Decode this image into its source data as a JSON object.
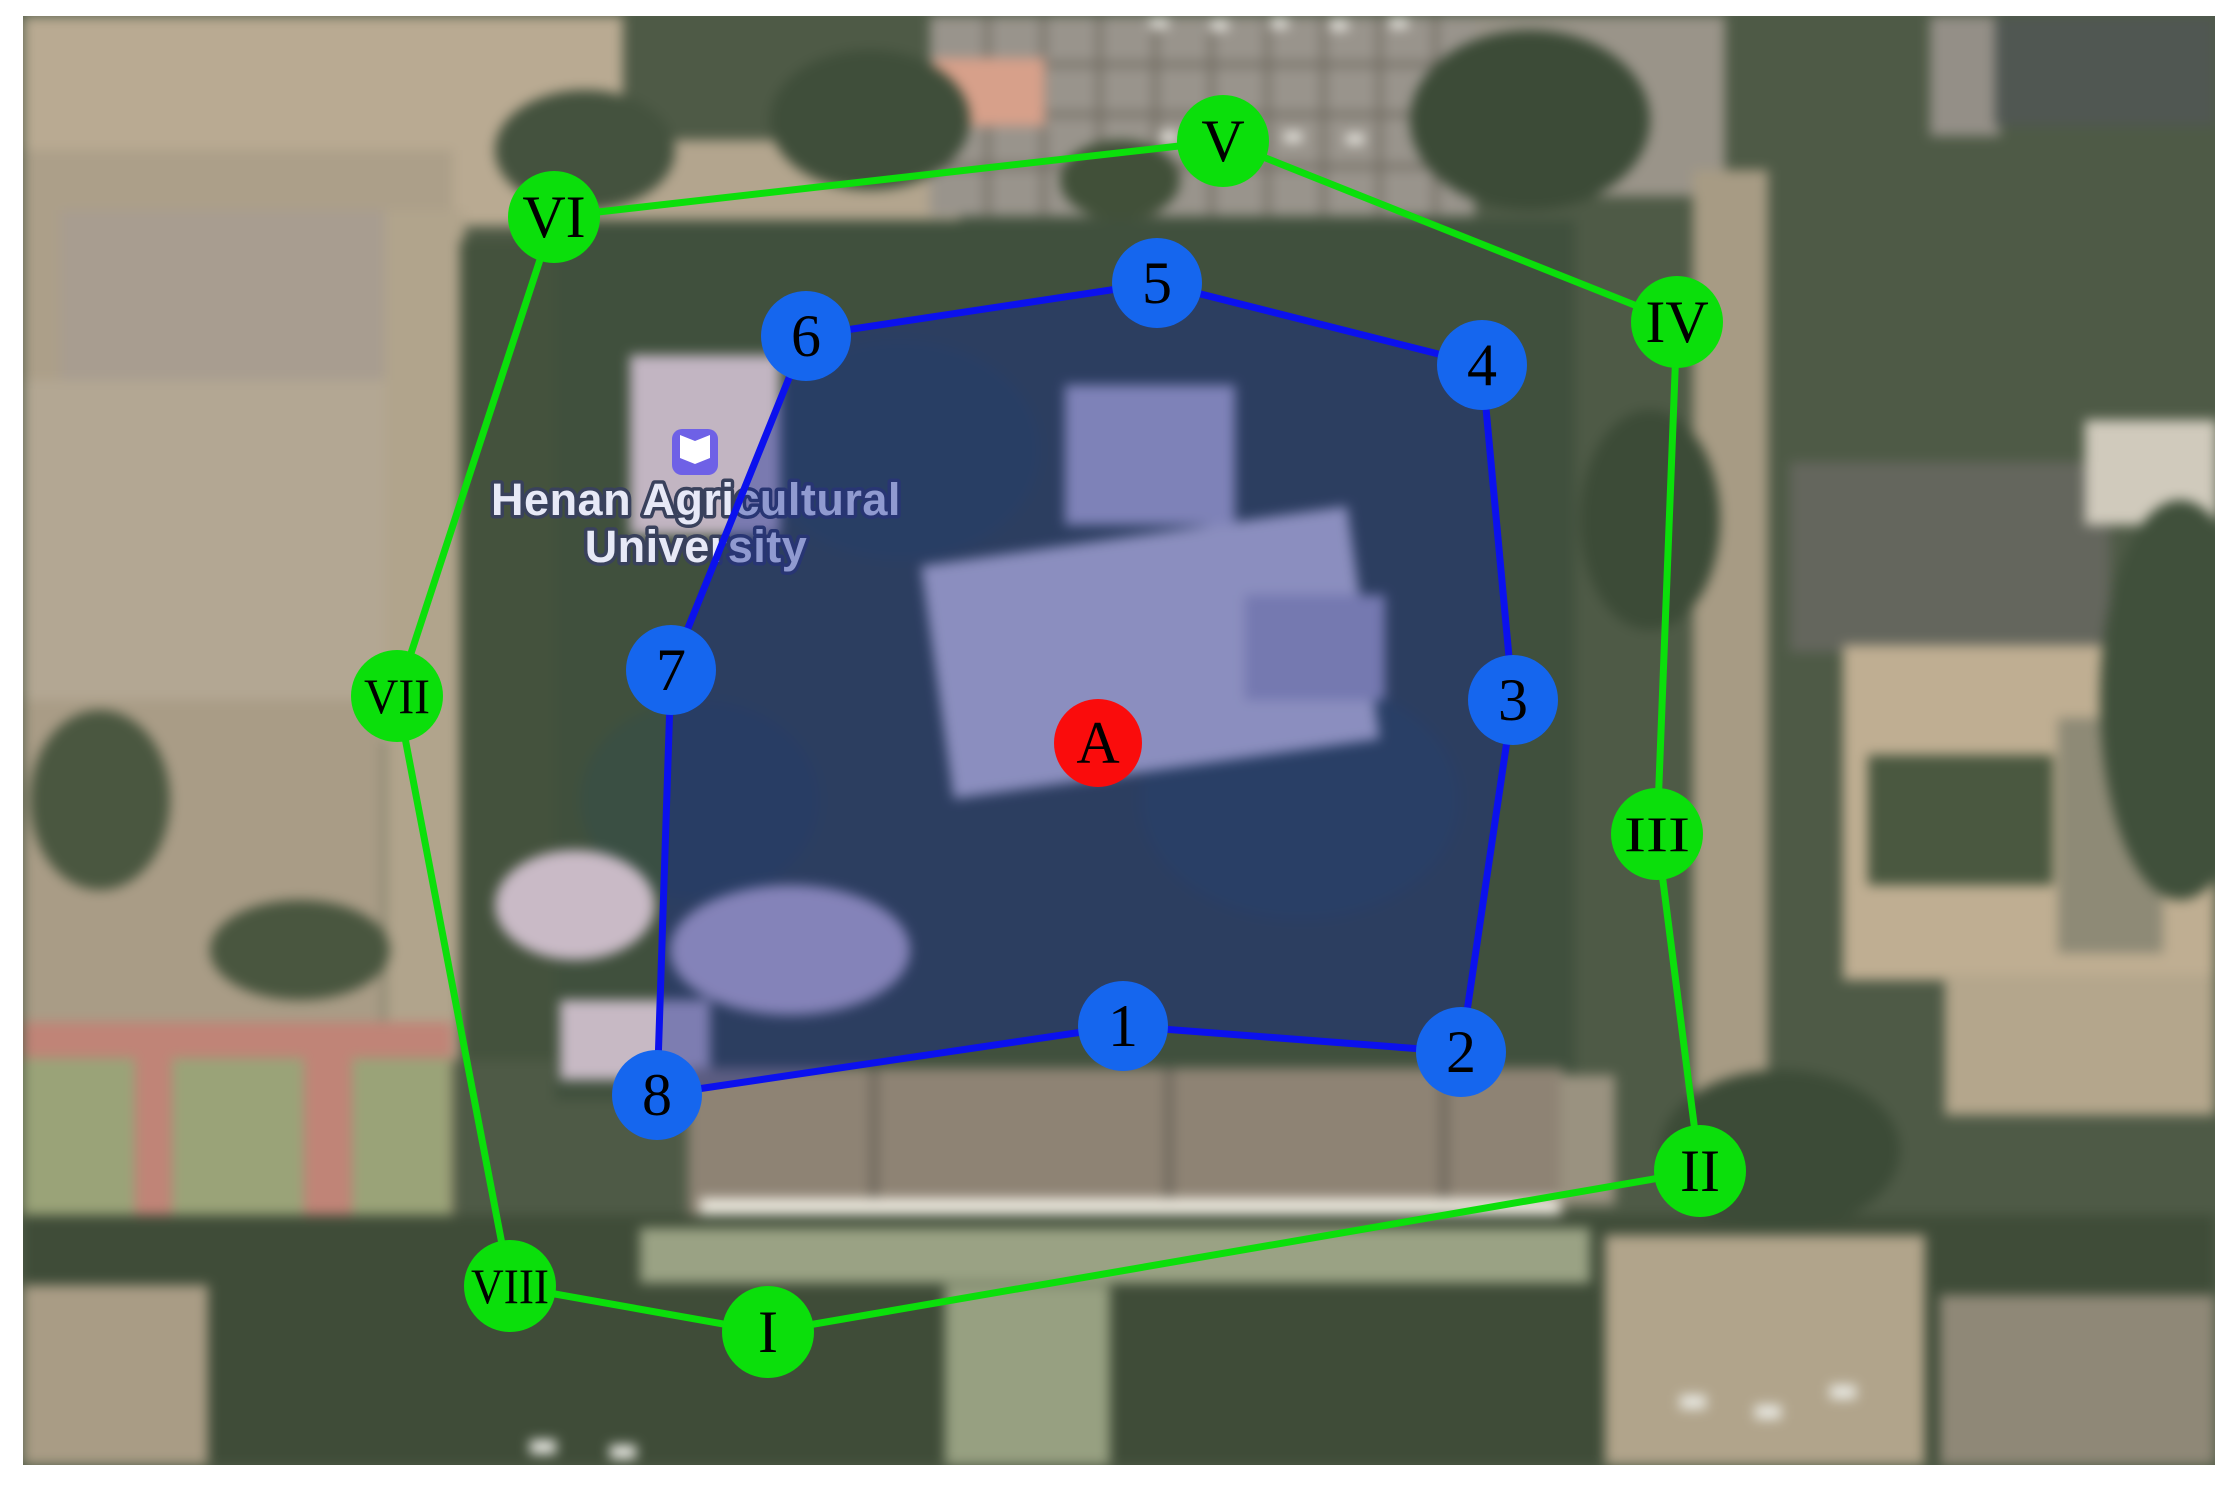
{
  "figure": {
    "type": "annotated-satellite-map",
    "canvas": {
      "width": 2234,
      "height": 1485,
      "border_color": "#ffffff"
    },
    "place_label": {
      "line1": "Henan Agricultural",
      "line2": "University",
      "icon": "education-book-icon",
      "icon_color": "#6e61e6",
      "icon_x": 695,
      "icon_y": 452,
      "text_color": "#e7e9f7",
      "halo_color": "#39415c",
      "x": 696,
      "line1_y": 515,
      "line2_y": 562
    },
    "outer_route": {
      "description": "outer sampling route with Roman-numeral sites",
      "color": "#0bdf0b",
      "marker_fill": "#0bdf0b",
      "line_width": 7,
      "marker_radius": 46,
      "label_color": "#000000",
      "points": [
        {
          "label": "I",
          "x": 768,
          "y": 1332
        },
        {
          "label": "II",
          "x": 1700,
          "y": 1171
        },
        {
          "label": "III",
          "x": 1657,
          "y": 834
        },
        {
          "label": "IV",
          "x": 1677,
          "y": 322
        },
        {
          "label": "V",
          "x": 1223,
          "y": 141
        },
        {
          "label": "VI",
          "x": 554,
          "y": 217
        },
        {
          "label": "VII",
          "x": 397,
          "y": 696
        },
        {
          "label": "VIII",
          "x": 510,
          "y": 1286
        }
      ]
    },
    "plot_boundary": {
      "description": "shaded study-plot boundary with numbered sites",
      "stroke_color": "#0b11ee",
      "fill_color": "rgba(16,36,150,0.40)",
      "marker_fill": "#1566ee",
      "line_width": 7,
      "marker_radius": 45,
      "label_color": "#000000",
      "points": [
        {
          "label": "1",
          "x": 1123,
          "y": 1026
        },
        {
          "label": "2",
          "x": 1461,
          "y": 1052
        },
        {
          "label": "3",
          "x": 1513,
          "y": 700
        },
        {
          "label": "4",
          "x": 1482,
          "y": 365
        },
        {
          "label": "5",
          "x": 1157,
          "y": 283
        },
        {
          "label": "6",
          "x": 806,
          "y": 336
        },
        {
          "label": "7",
          "x": 671,
          "y": 670
        },
        {
          "label": "8",
          "x": 657,
          "y": 1095
        }
      ]
    },
    "site_marker": {
      "label": "A",
      "x": 1098,
      "y": 743,
      "radius": 44,
      "fill": "#fa0c0c",
      "label_color": "#000000"
    }
  }
}
